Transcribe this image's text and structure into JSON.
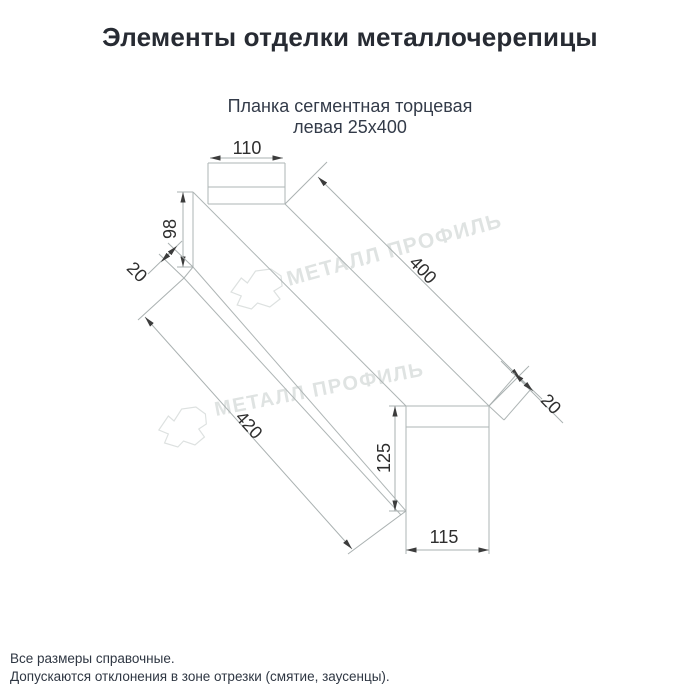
{
  "page": {
    "title": "Элементы отделки металлочерепицы"
  },
  "drawing": {
    "subtitle_line1": "Планка сегментная торцевая",
    "subtitle_line2": "левая 25х400",
    "dimensions": {
      "top_width": "110",
      "left_height": "98",
      "near_lip": "20",
      "length": "400",
      "bottom_length": "420",
      "far_lip": "20",
      "far_height": "125",
      "far_width": "115"
    },
    "watermark": {
      "brand": "МЕТАЛЛ ПРОФИЛЬ",
      "logo": "cloud-logo"
    }
  },
  "footer": {
    "note1": "Все размеры справочные.",
    "note2": "Допускаются отклонения в зоне отрезки (смятие, заусенцы)."
  },
  "colors": {
    "background": "#ffffff",
    "title_text": "#272b33",
    "drawing_lines": "#aeb5b5",
    "dimension_text": "#2e2e2e",
    "watermark": "#dfe3e2"
  }
}
